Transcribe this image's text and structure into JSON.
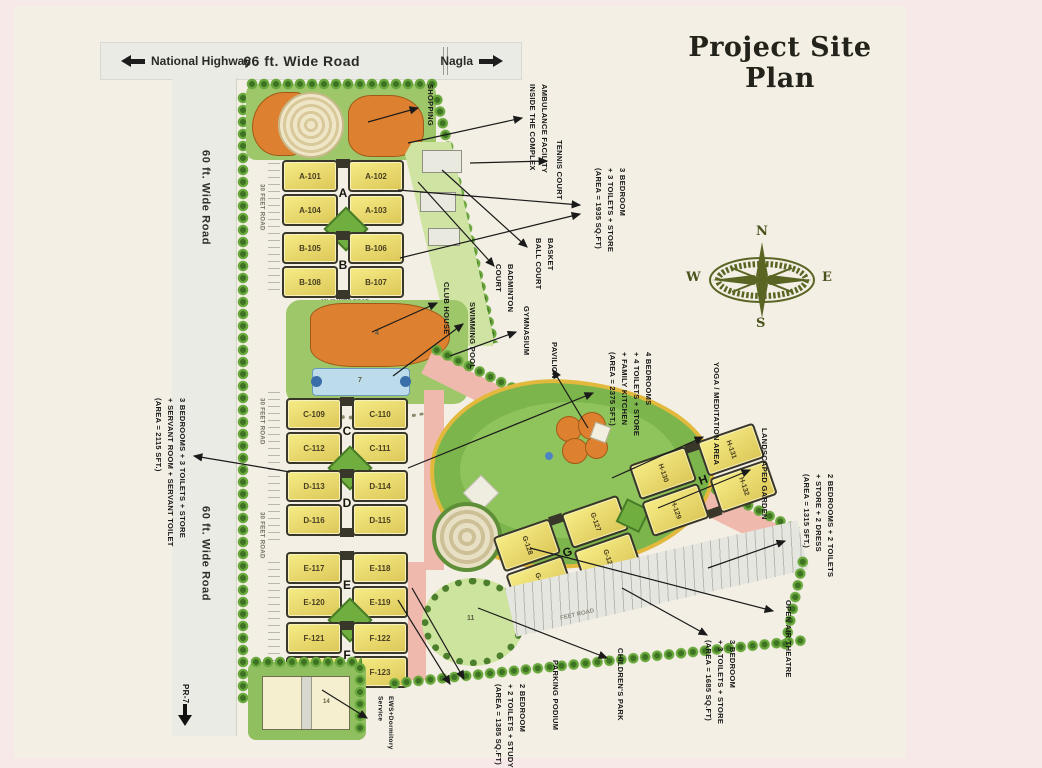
{
  "title": "Project Site Plan",
  "roads": {
    "top_left": "National Highway",
    "top_center": "66 ft. Wide Road",
    "top_right": "Nagla",
    "left_upper": "60 ft. Wide Road",
    "left_lower": "60 ft. Wide Road",
    "inner": "30 FEET ROAD",
    "inner_small": "16'-0\" WIDE ROAD",
    "diag": "FEET ROAD",
    "pr7": "PR-7"
  },
  "compass": {
    "n": "N",
    "e": "E",
    "s": "S",
    "w": "W"
  },
  "blocks": [
    {
      "letter": "A",
      "units": [
        "A-101",
        "A-102",
        "A-104",
        "A-103"
      ]
    },
    {
      "letter": "B",
      "units": [
        "B-105",
        "B-106",
        "B-108",
        "B-107"
      ]
    },
    {
      "letter": "C",
      "units": [
        "C-109",
        "C-110",
        "C-112",
        "C-111"
      ]
    },
    {
      "letter": "D",
      "units": [
        "D-113",
        "D-114",
        "D-116",
        "D-115"
      ]
    },
    {
      "letter": "E",
      "units": [
        "E-117",
        "E-118",
        "E-120",
        "E-119"
      ]
    },
    {
      "letter": "F",
      "units": [
        "F-121",
        "F-122",
        "F-124",
        "F-123"
      ]
    },
    {
      "letter": "G",
      "units": [
        "G-128",
        "G-127",
        "G-125",
        "G-126"
      ]
    },
    {
      "letter": "H",
      "units": [
        "H-130",
        "H-131",
        "H-129",
        "H-132"
      ]
    }
  ],
  "callouts": {
    "shopping": "SHOPPING",
    "ambulance": "AMBULANCE FACILITY\nINSIDE THE COMPLEX",
    "tennis": "TENNIS COURT",
    "type_ab": "3 BEDROOM\n+ 3 TOILETS + STORE\n(AREA = 1935 SQ.FT)",
    "basketball": "BASKET\nBALL COURT",
    "badminton": "BADMINTON\nCOURT",
    "club_house": "CLUB HOUSE",
    "swimming_pool": "SWIMMING POOL",
    "gymnasium": "GYMNASIUM",
    "pavilion": "PAVILION",
    "type_cd": "4 BEDROOMS\n+ 4 TOILETS + STORE\n+ FAMILY KITCHEN\n(AREA = 2375 SFT.)",
    "yoga": "YOGA / MEDITATION AREA",
    "garden": "LANDSCAPED GARDEN",
    "type_h": "2 BEDROOMS + 2 TOILETS\n+ STORE + 2 DRESS\n(AREA = 1315 SFT.)",
    "theatre": "OPEN AIR THEATRE",
    "type_g": "3 BEDROOM\n+ 3 TOILETS + STORE\n(AREA = 1685 SQ.FT)",
    "children": "CHILDREN'S PARK",
    "parking": "PARKING PODIUM",
    "type_ef": "2 BEDROOM\n+ 2 TOILETS + STUDY\n(AREA = 1385 SQ.FT)",
    "type_servant": "3 BEDROOMS + 3 TOILETS + STORE\n+ SERVANT ROOM + SERVANT TOILET\n(AREA = 2115 SFT.)",
    "ews": "EWS+Dormitory\nService"
  },
  "map_numbers": {
    "club_house": "4",
    "pool": "7",
    "children_park": "11",
    "ews": "14"
  },
  "colors": {
    "paper": "#f3efe4",
    "page_pink": "#f6e9e7",
    "building_yellow": "#ecd96a",
    "building_outline": "#39362a",
    "orange_building": "#dd8130",
    "grass": "#9ec76a",
    "garden_green": "#7cb54b",
    "pool_blue": "#bcdcec",
    "road_gray": "#ebebe6",
    "pink_road": "#f0b9ad",
    "path_yellow": "#e3b93d",
    "compass_olive": "#5a6524"
  }
}
